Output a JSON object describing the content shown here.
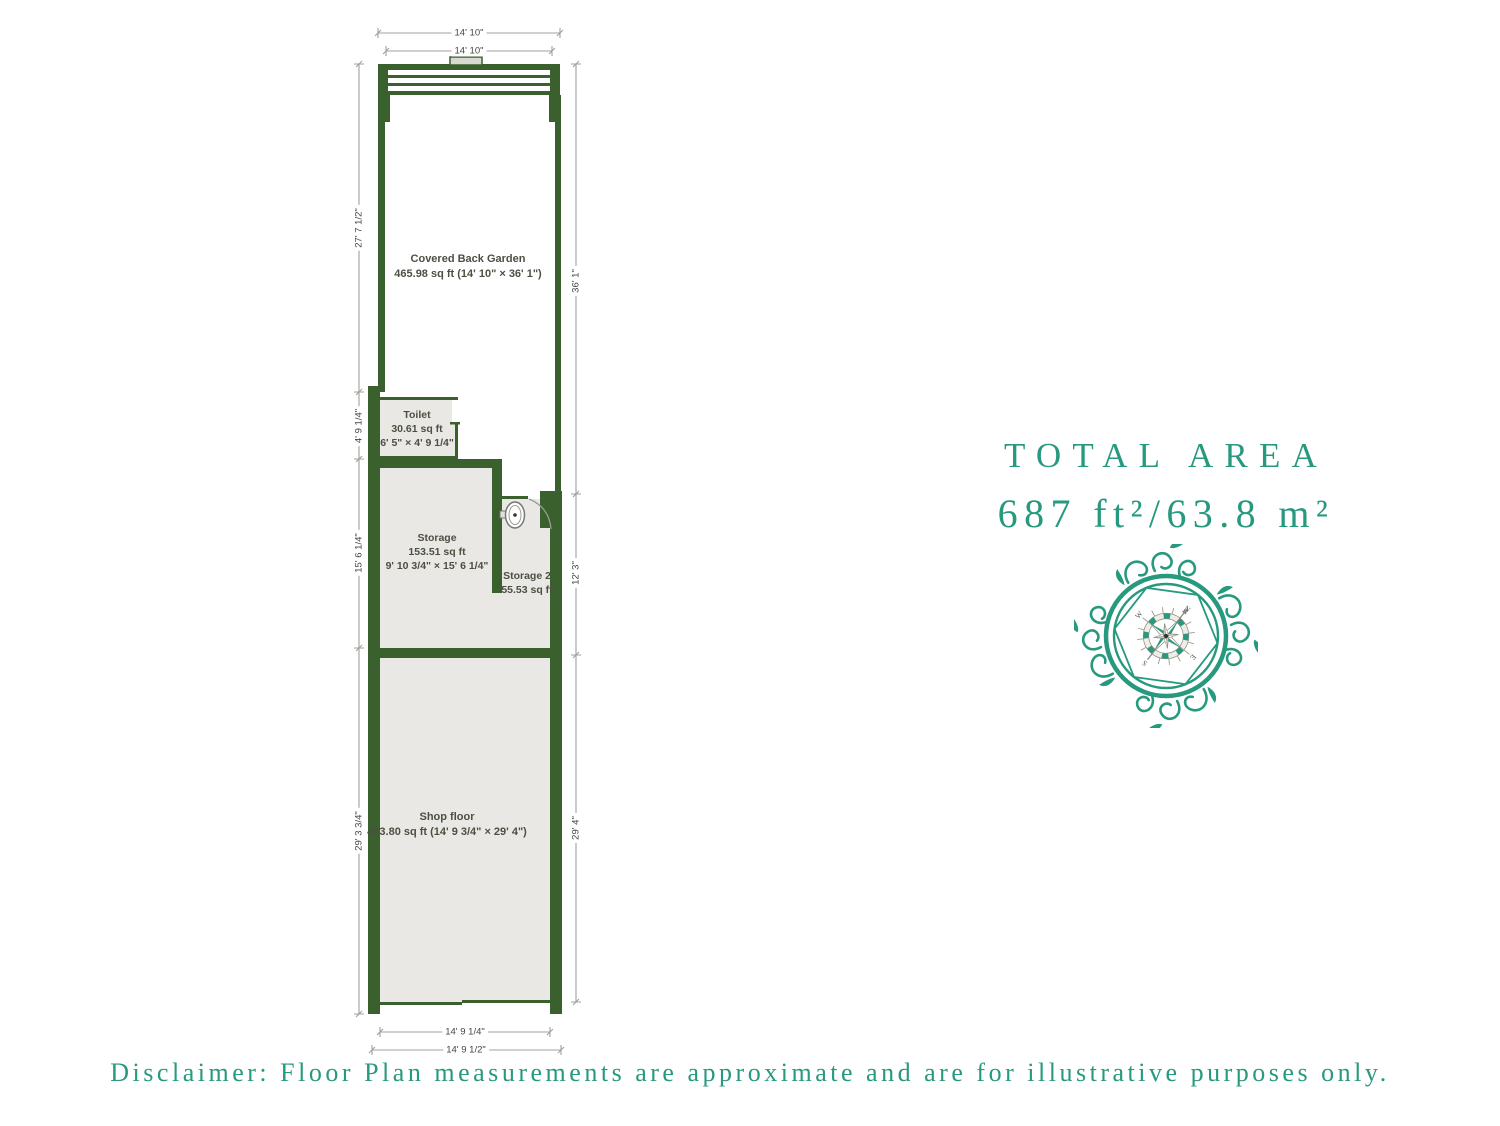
{
  "colors": {
    "wall_green": "#3a612d",
    "room_fill": "#e9e8e4",
    "accent_teal": "#27997e",
    "dim_gray": "#a0a099"
  },
  "rooms": {
    "garden": {
      "name": "Covered Back Garden",
      "area": "465.98 sq ft (14' 10\" × 36' 1\")"
    },
    "toilet": {
      "name": "Toilet",
      "area": "30.61 sq ft",
      "dims": "6' 5\" × 4' 9 1/4\""
    },
    "storage": {
      "name": "Storage",
      "area": "153.51 sq ft",
      "dims": "9' 10 3/4\" × 15' 6 1/4\""
    },
    "storage2": {
      "name": "Storage 2",
      "area": "55.53 sq ft"
    },
    "shop": {
      "name": "Shop floor",
      "area": "433.80 sq ft (14' 9 3/4\" × 29' 4\")"
    }
  },
  "dimensions": {
    "top_outer": "14' 10\"",
    "top_inner": "14' 10\"",
    "left_garden": "27' 7 1/2\"",
    "left_toilet": "4' 9 1/4\"",
    "left_storage": "15' 6 1/4\"",
    "left_shop": "29' 3 3/4\"",
    "right_garden": "36' 1\"",
    "right_storage2": "12' 3\"",
    "right_shop": "29' 4\"",
    "bottom_inner": "14' 9 1/4\"",
    "bottom_outer": "14' 9 1/2\""
  },
  "total_area": {
    "label": "TOTAL AREA",
    "value": "687 ft²/63.8 m²"
  },
  "compass": {
    "n": "N",
    "e": "E",
    "s": "S",
    "w": "W"
  },
  "disclaimer": "Disclaimer: Floor Plan measurements are approximate and are for illustrative purposes only."
}
